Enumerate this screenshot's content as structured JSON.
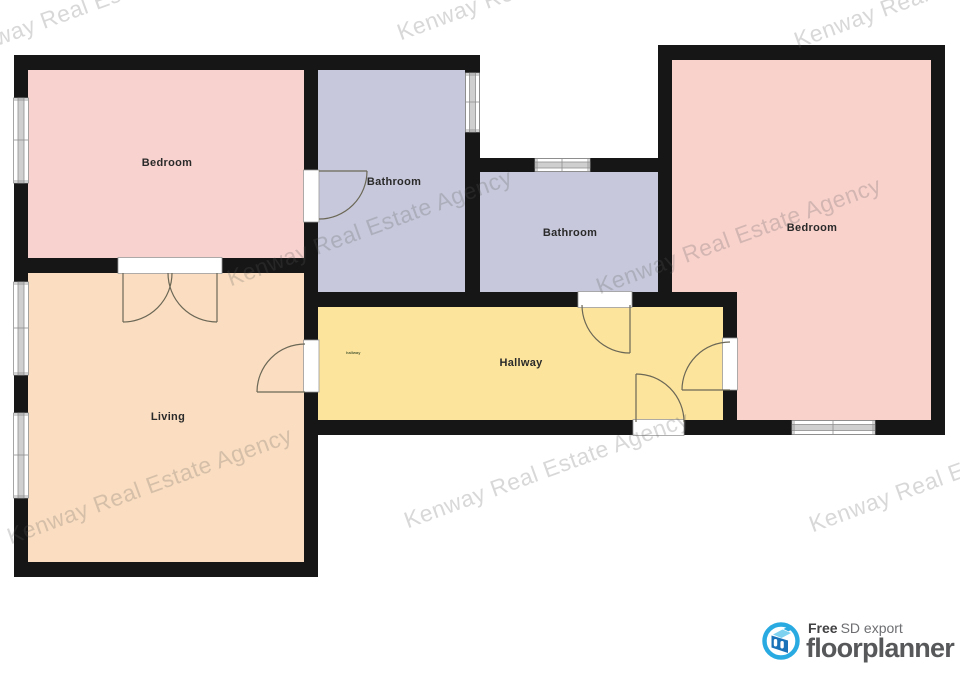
{
  "watermark": {
    "text": "Kenway Real Estate Agency"
  },
  "colors": {
    "wall": "#161616",
    "window_band": "#cfcfcf",
    "arc": "#6b6756"
  },
  "rooms": {
    "bedroom1": {
      "label": "Bedroom",
      "color": "#f8d2ce"
    },
    "bathroom1": {
      "label": "Bathroom",
      "color": "#c7c8db"
    },
    "bathroom2": {
      "label": "Bathroom",
      "color": "#c7c8db"
    },
    "bedroom2": {
      "label": "Bedroom",
      "color": "#f9d2cc"
    },
    "living": {
      "label": "Living",
      "color": "#fbdec1"
    },
    "hallway": {
      "label": "Hallway",
      "color": "#fce49c",
      "mini_label": "hallway"
    }
  },
  "footer": {
    "free_label": "Free",
    "export_label": "SD export",
    "brand": "floorplanner",
    "brand_color": "#29abe2"
  }
}
